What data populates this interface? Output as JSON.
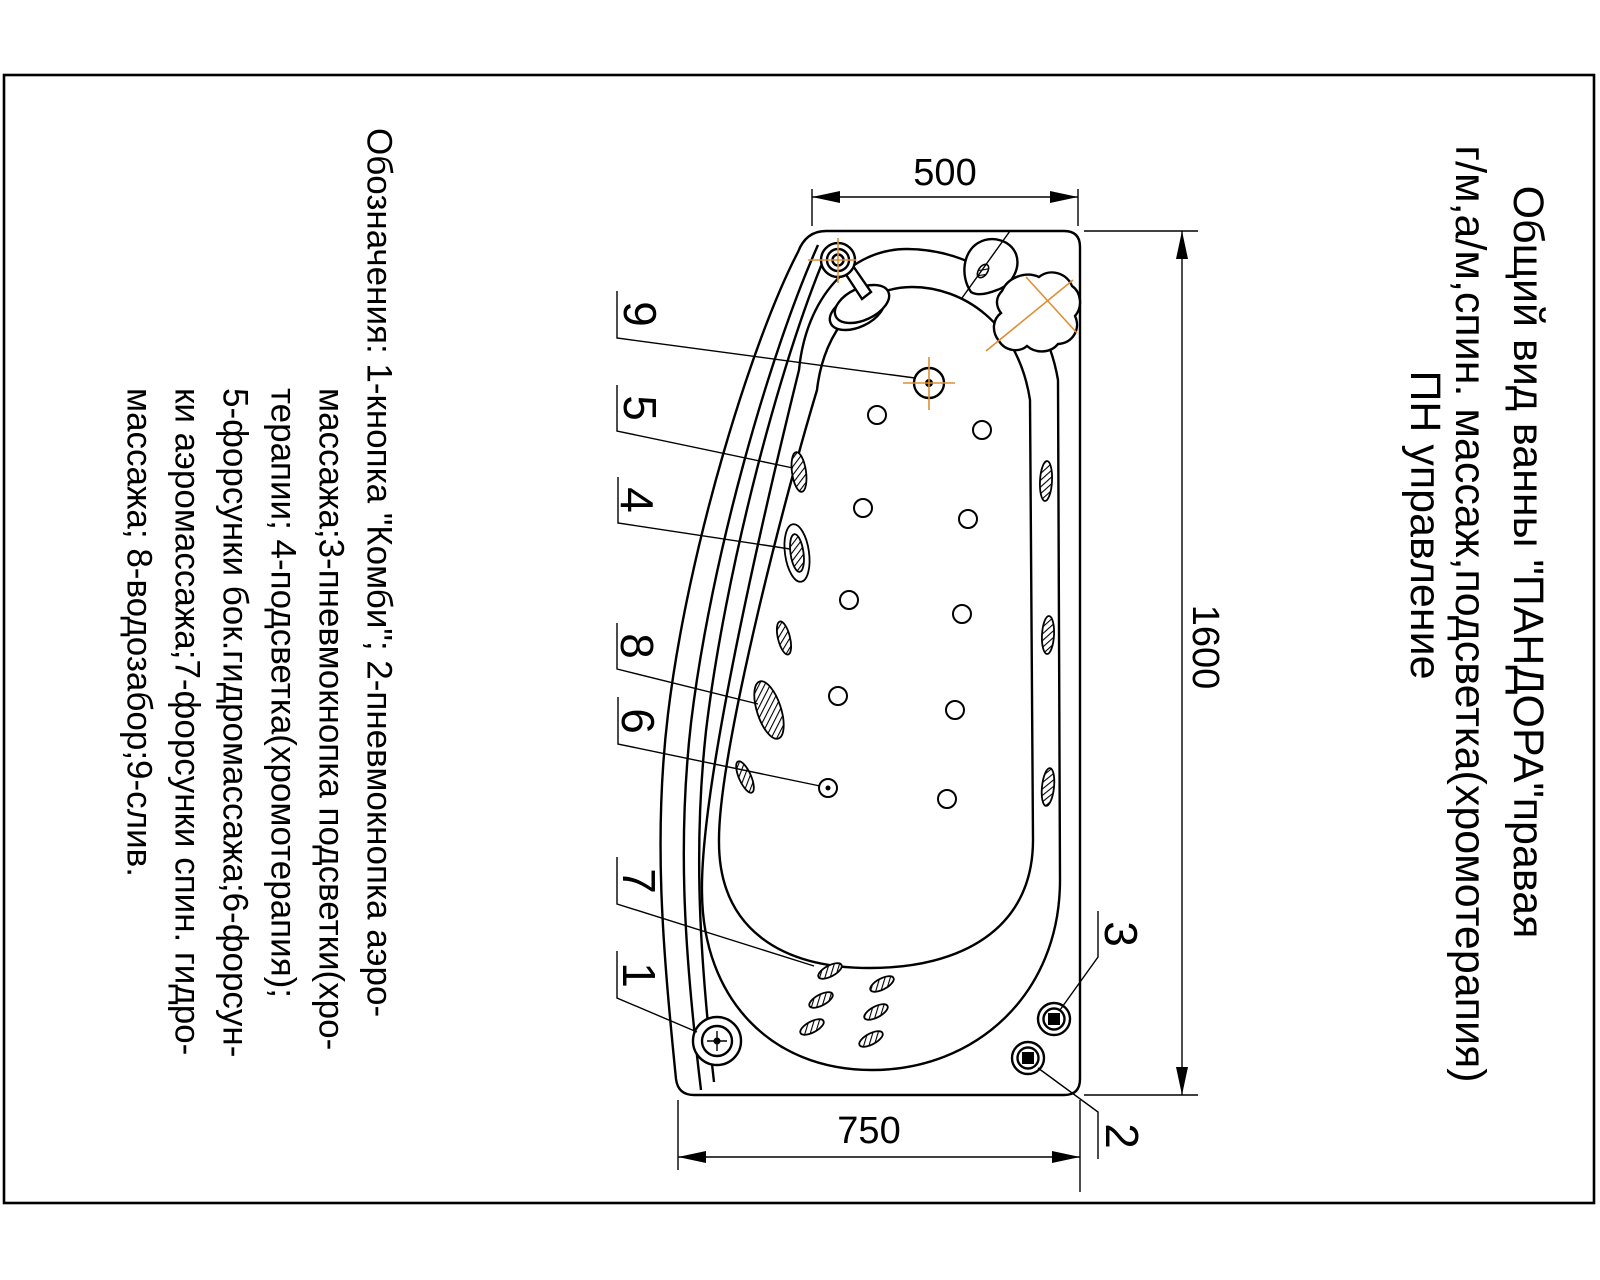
{
  "title": {
    "lines": [
      "Общий вид ванны \"ПАНДОРА\"правая",
      "г/м,а/м,спин. массаж,подсветка(хромотерапия)",
      "ПН управление"
    ]
  },
  "legend": {
    "lines": [
      "Обозначения: 1-кнопка \"Комби\"; 2-пневмокнопка аэро-",
      "массажа;3-пневмокнопка подсветки(хро-",
      "терапии; 4-подсветка(хромотерапия);",
      "5-форсунки бок.гидромассажа;6-форсун-",
      "ки аэромассажа;7-форсунки спин. гидро-",
      "массажа; 8-водозабор;9-слив."
    ]
  },
  "dimensions": {
    "top_width": "500",
    "overall_length": "1600",
    "bottom_width": "750"
  },
  "callouts": [
    {
      "label": "9"
    },
    {
      "label": "5"
    },
    {
      "label": "4"
    },
    {
      "label": "8"
    },
    {
      "label": "6"
    },
    {
      "label": "7"
    },
    {
      "label": "1"
    },
    {
      "label": "3"
    },
    {
      "label": "2"
    }
  ],
  "colors": {
    "line": "#000000",
    "construction": "#dd8f33",
    "paper": "#ffffff"
  }
}
